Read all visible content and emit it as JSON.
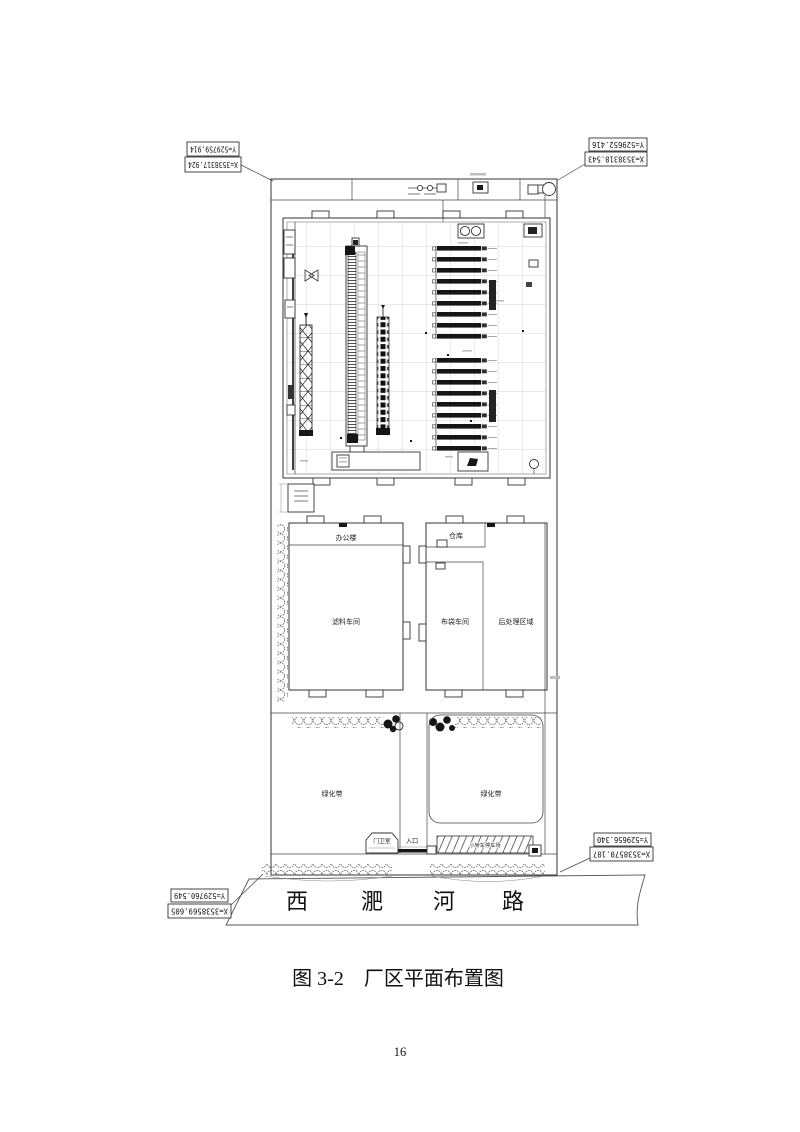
{
  "figure": {
    "caption": "图 3-2　厂区平面布置图",
    "caption_figure_no": "图 3-2",
    "caption_title": "厂区平面布置图"
  },
  "page": {
    "number": "16"
  },
  "coordinates": {
    "top_left": {
      "y_label": "Y=529759.914",
      "x_label": "X=3538317.924"
    },
    "top_right": {
      "y_label": "Y=529652.416",
      "x_label": "X=3538318.543"
    },
    "bottom_right": {
      "y_label": "Y=529656.340",
      "x_label": "X=3538570.107"
    },
    "bottom_left": {
      "y_label": "Y=529760.549",
      "x_label": "X=3538569.605"
    }
  },
  "road": {
    "name": "西淝河路",
    "chars": [
      "西",
      "淝",
      "河",
      "路"
    ]
  },
  "labels": {
    "office_building": "办公楼",
    "filter_material_workshop": "滤料车间",
    "warehouse": "仓库",
    "bag_workshop": "布袋车间",
    "post_processing_area": "后处理区域",
    "greenbelt_left": "绿化带",
    "greenbelt_right": "绿化带",
    "guard_room": "门卫室",
    "entrance": "入口",
    "parking_lot": "小轿车停车场"
  },
  "colors": {
    "line": "#333333",
    "background": "#ffffff"
  }
}
